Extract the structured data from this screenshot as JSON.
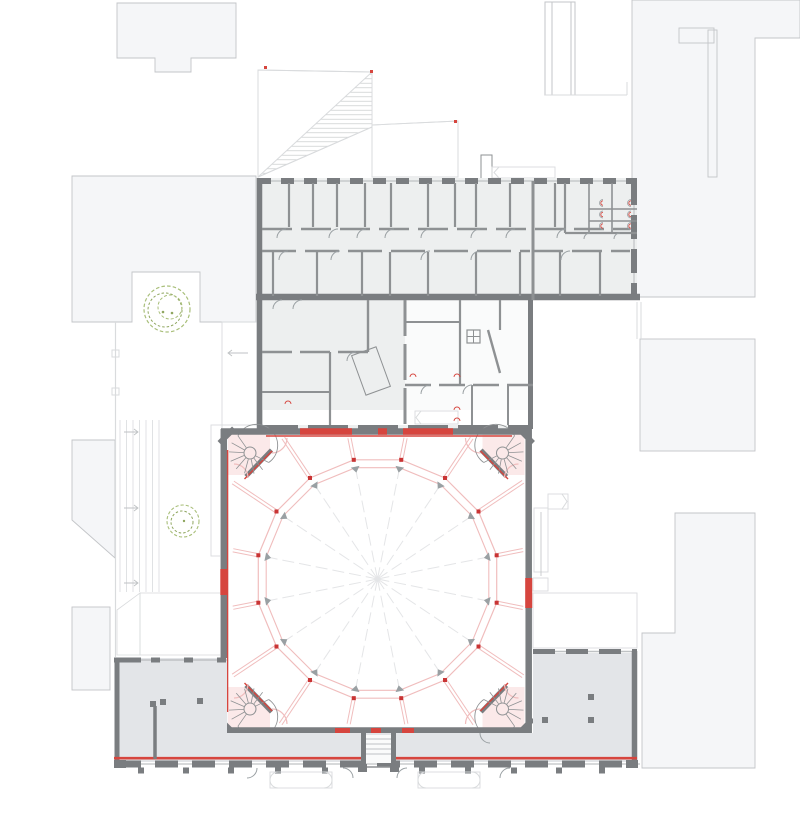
{
  "document": {
    "kind": "architectural-floor-plan",
    "visible_text": [],
    "description_tags": [
      "site-plan",
      "circular-arena-hall",
      "context-buildings"
    ]
  },
  "palette": {
    "bg": "#ffffff",
    "context_fill": "#f5f6f8",
    "context_line": "#c3c5c8",
    "wing_fill": "#edefef",
    "room_fill": "#fafbfb",
    "southwing_fill": "#e3e5e8",
    "wall": "#7a7d80",
    "wall_mid": "#8e9193",
    "hatch_line": "#cfd1d3",
    "tread_line": "#bfc2c4",
    "faint_line": "#d9dbdd",
    "door_arc": "#9aa0a3",
    "pink_fill": "#fbe9e9",
    "pink_line": "#f0bdbd",
    "node_red": "#c93434",
    "accent_red": "#d6453e",
    "tree_green": "#a9bf7a",
    "tree_green_dark": "#8fa65f",
    "column": "#6e7174",
    "spoke": "#e4e5e7",
    "hall_floor": "#ffffff"
  },
  "arena": {
    "sides": 16,
    "center_x": 377.5,
    "center_y": 579,
    "outer_radius": 121.5,
    "inner_radius": 113.5,
    "start_angle_deg": 78.75,
    "node_size": 4,
    "radial_box": {
      "x1": 233,
      "y1": 438,
      "x2": 523,
      "y2": 724
    }
  },
  "features": {
    "corner_stair_pavilions": 4,
    "trees": 2,
    "roof_hatch_areas": 3,
    "entry_step_strips": 2,
    "toilet_fixtures": 6
  }
}
